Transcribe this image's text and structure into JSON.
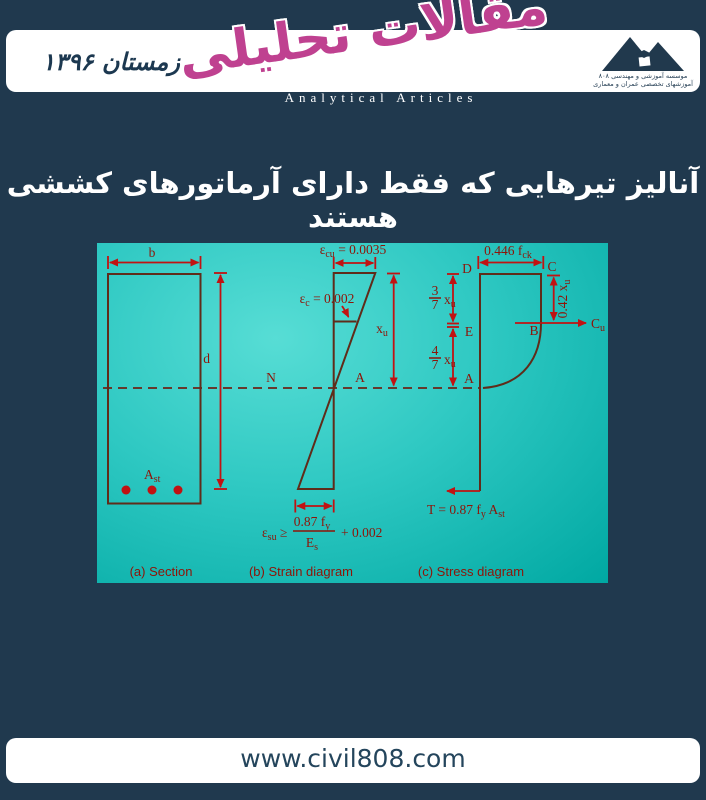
{
  "header": {
    "date": "زمستان ۱۳۹۶",
    "logo_main": "مقالات تحلیلی",
    "logo_sub": "Analytical Articles",
    "org_line1": "موسسه آموزشی و مهندسی ۸۰۸",
    "org_line2": "آموزشهای تخصصی عمران و معماری"
  },
  "title": "آنالیز تیرهایی که فقط دارای آرماتورهای کششی هستند",
  "footer": {
    "url": "www.civil808.com"
  },
  "colors": {
    "background": "#20394e",
    "panel_cyan_light": "#57ddd5",
    "panel_cyan_dark": "#00a8a2",
    "shape_line": "#5f2c1a",
    "arrow_red": "#c11212",
    "label_red": "#8e1408",
    "logo_magenta": "#bf4190",
    "band_white": "#ffffff"
  },
  "diagram": {
    "section": {
      "caption": "(a) Section",
      "b": "b",
      "d": "d",
      "ast": "A",
      "ast_sub": "st",
      "rebar_count": 3
    },
    "strain": {
      "caption": "(b) Strain diagram",
      "ecu_eps": "ε",
      "ecu_sub": "cu",
      "ecu_val": " = 0.0035",
      "ec_eps": "ε",
      "ec_sub": "c",
      "ec_val": " = 0.002",
      "xu": "x",
      "xu_sub": "u",
      "n_pt": "N",
      "a_pt": "A",
      "esu_eps": "ε",
      "esu_sub": "su",
      "esu_ge": " ≥",
      "frac_num": "0.87 f",
      "frac_num_sub": "y",
      "frac_den": "E",
      "frac_den_sub": "s",
      "tail": "+ 0.002"
    },
    "stress": {
      "caption": "(c) Stress diagram",
      "fck": "0.446 f",
      "fck_sub": "ck",
      "d_pt": "D",
      "c_pt": "C",
      "e_pt": "E",
      "b_pt": "B",
      "a_pt": "A",
      "x042": "0.42 x",
      "x042_sub": "u",
      "cu": "C",
      "cu_sub": "u",
      "f37_num": "3",
      "f37_den": "7",
      "f47_num": "4",
      "f47_den": "7",
      "xu": "x",
      "xu_sub": "u",
      "t1": "T = 0.87 f",
      "t1_sub": "y",
      "t2": " A",
      "t2_sub": "st"
    }
  }
}
